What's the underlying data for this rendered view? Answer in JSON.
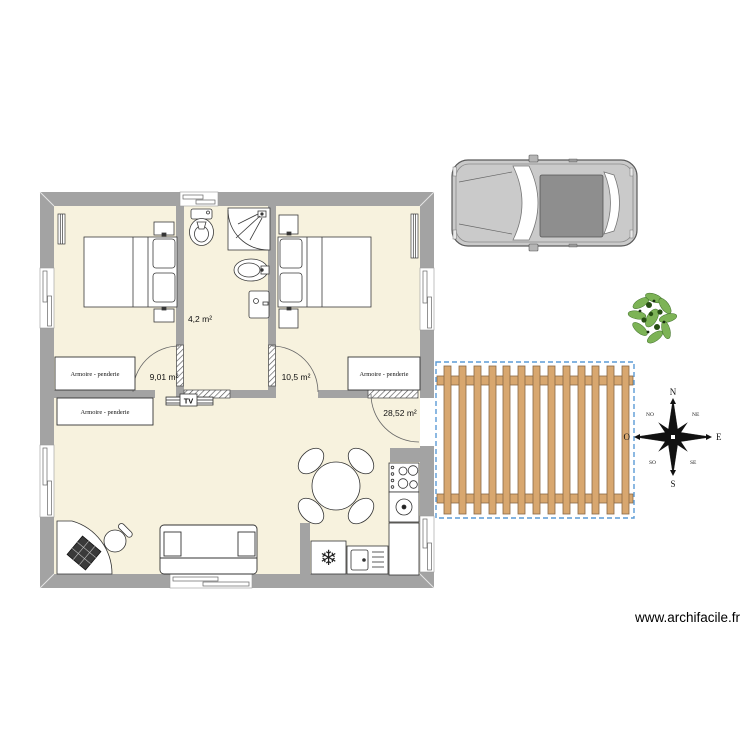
{
  "plan": {
    "rooms": [
      {
        "id": "bedroom-left",
        "area_label": "9,01 m²"
      },
      {
        "id": "bathroom",
        "area_label": "4,2 m²"
      },
      {
        "id": "bedroom-right",
        "area_label": "10,5 m²"
      },
      {
        "id": "living-room",
        "area_label": "28,52 m²"
      }
    ],
    "wardrobes": [
      {
        "label": "Armoire - penderie"
      },
      {
        "label": "Armoire - penderie"
      },
      {
        "label": "Armoire - penderie"
      }
    ],
    "tv_label": "TV"
  },
  "compass": {
    "north": "N",
    "northeast": "NE",
    "east": "E",
    "southeast": "SE",
    "south": "S",
    "southwest": "SO",
    "west": "O",
    "northwest": "NO"
  },
  "icons": {
    "freezer_snowflake": "❄"
  },
  "footer": {
    "watermark": "www.archifacile.fr"
  },
  "colors": {
    "floor": "#f7f2de",
    "wall": "#a3a3a3",
    "wood": "#d8a76f",
    "wood_edge": "#8a6844",
    "selection_dash": "#5b9bd5",
    "tree_green": "#6aa84f",
    "car_body": "#cacaca",
    "car_roof": "#8e8e8e"
  }
}
